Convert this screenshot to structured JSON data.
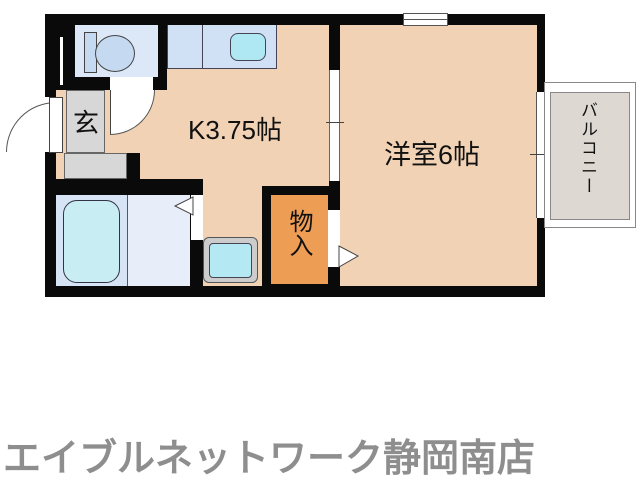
{
  "floorplan": {
    "kitchen": {
      "label": "K3.75帖"
    },
    "western_room": {
      "label": "洋室6帖"
    },
    "entrance": {
      "label": "玄"
    },
    "closet": {
      "label": "物入"
    },
    "balcony": {
      "label": "バルコニー"
    }
  },
  "fixtures": {
    "toilet": "toilet-icon",
    "kitchen_sink": "kitchen-sink-icon",
    "bathtub": "bathtub-icon",
    "washing_machine": "washing-machine-pan-icon"
  },
  "footer": {
    "shop_name": "エイブルネットワーク静岡南店"
  },
  "colors": {
    "wall": "#0a0a0a",
    "floor_peach": "#f1d2b4",
    "closet_orange": "#ee9d54",
    "entrance_gray": "#d7d7d7",
    "toilet_room_blue": "#dce8f8",
    "counter_blue": "#d0e1f5",
    "sink_cyan": "#afe8f3",
    "bathtub_cyan": "#c8edf3",
    "balcony_gray": "#ddd8d2",
    "footer_text": "#8e8e8e"
  }
}
